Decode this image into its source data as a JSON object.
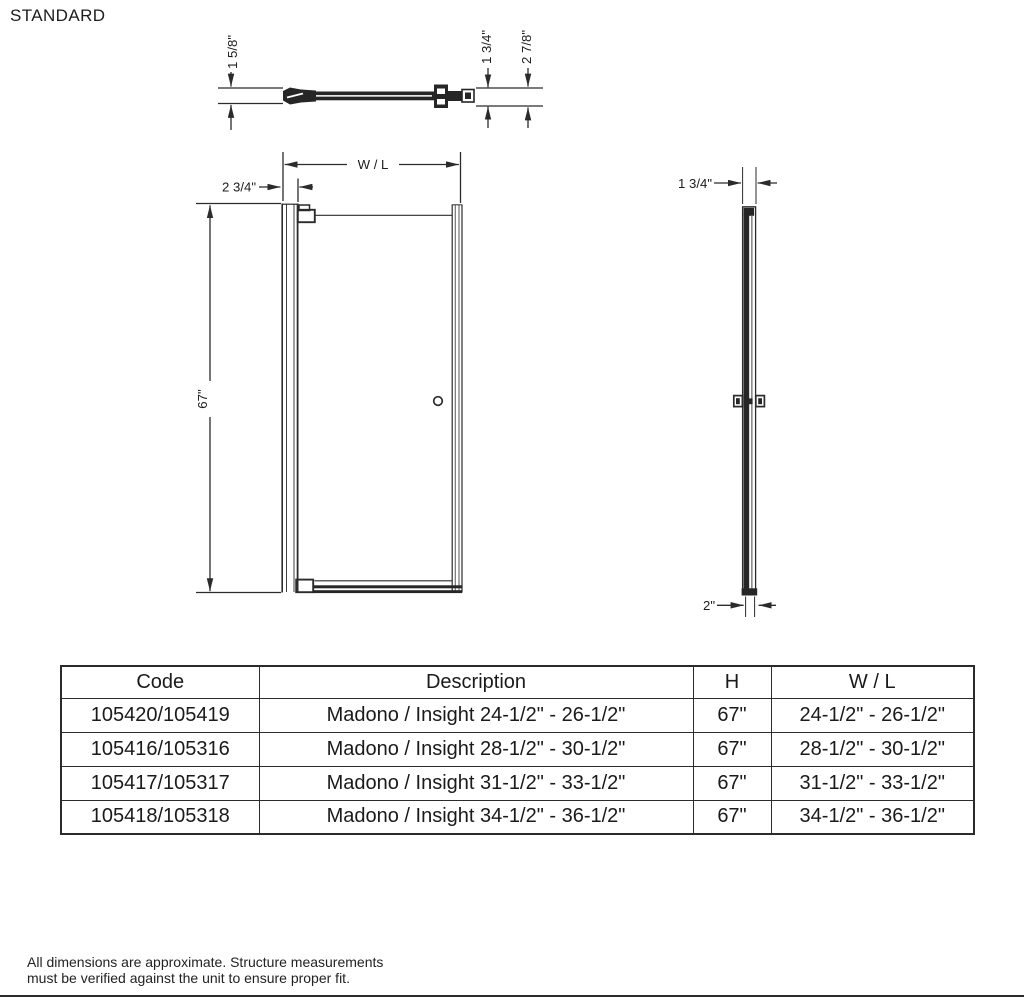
{
  "title": "STANDARD",
  "drawing": {
    "top_view": {
      "wall_profile_height": "1 5/8\"",
      "glass_assembly_depth": "1 3/4\"",
      "total_depth": "2 7/8\""
    },
    "front_view": {
      "width_label": "W / L",
      "hinge_side_offset": "2 3/4\"",
      "height": "67\""
    },
    "side_view": {
      "top_width": "1 3/4\"",
      "bottom_width": "2\""
    }
  },
  "table": {
    "headers": [
      "Code",
      "Description",
      "H",
      "W / L"
    ],
    "rows": [
      {
        "code": "105420/105419",
        "description": "Madono / Insight 24-1/2\" - 26-1/2\"",
        "h": "67\"",
        "wl": "24-1/2\" - 26-1/2\""
      },
      {
        "code": "105416/105316",
        "description": "Madono / Insight 28-1/2\" - 30-1/2\"",
        "h": "67\"",
        "wl": "28-1/2\" - 30-1/2\""
      },
      {
        "code": "105417/105317",
        "description": "Madono / Insight 31-1/2\" - 33-1/2\"",
        "h": "67\"",
        "wl": "31-1/2\" - 33-1/2\""
      },
      {
        "code": "105418/105318",
        "description": "Madono / Insight 34-1/2\" - 36-1/2\"",
        "h": "67\"",
        "wl": "34-1/2\" - 36-1/2\""
      }
    ]
  },
  "footnote": {
    "line1": "All dimensions are approximate. Structure measurements",
    "line2": "must be verified against the unit to ensure proper fit."
  },
  "colors": {
    "line": "#2b2b2b",
    "text": "#1c1c1c",
    "background": "#ffffff"
  }
}
